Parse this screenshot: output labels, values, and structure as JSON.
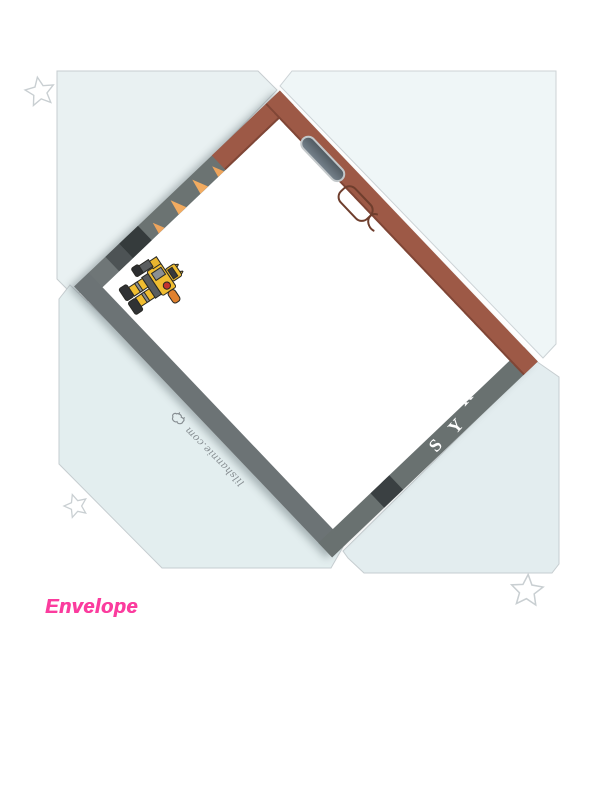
{
  "document": {
    "title": "Envelope",
    "credit": "lilshannie.com",
    "card_edge_letters": [
      "R",
      "Y",
      "S"
    ]
  },
  "icons": {
    "stars": "star-outline",
    "mascot": "bumblebee-robot",
    "credit_logo": "doodle-logo"
  },
  "colors": {
    "flap_blue": "#e9f1f2",
    "flap_blue_light": "#eff6f7",
    "card_brown": "#9d5946",
    "card_gray": "#6b7372",
    "card_charcoal": "#3a4042",
    "hazard_orange": "#f2ab60",
    "bumblebee_yellow": "#f0bd31",
    "title_pink": "#fb3c9e",
    "star_outline": "#c9cfd2"
  }
}
